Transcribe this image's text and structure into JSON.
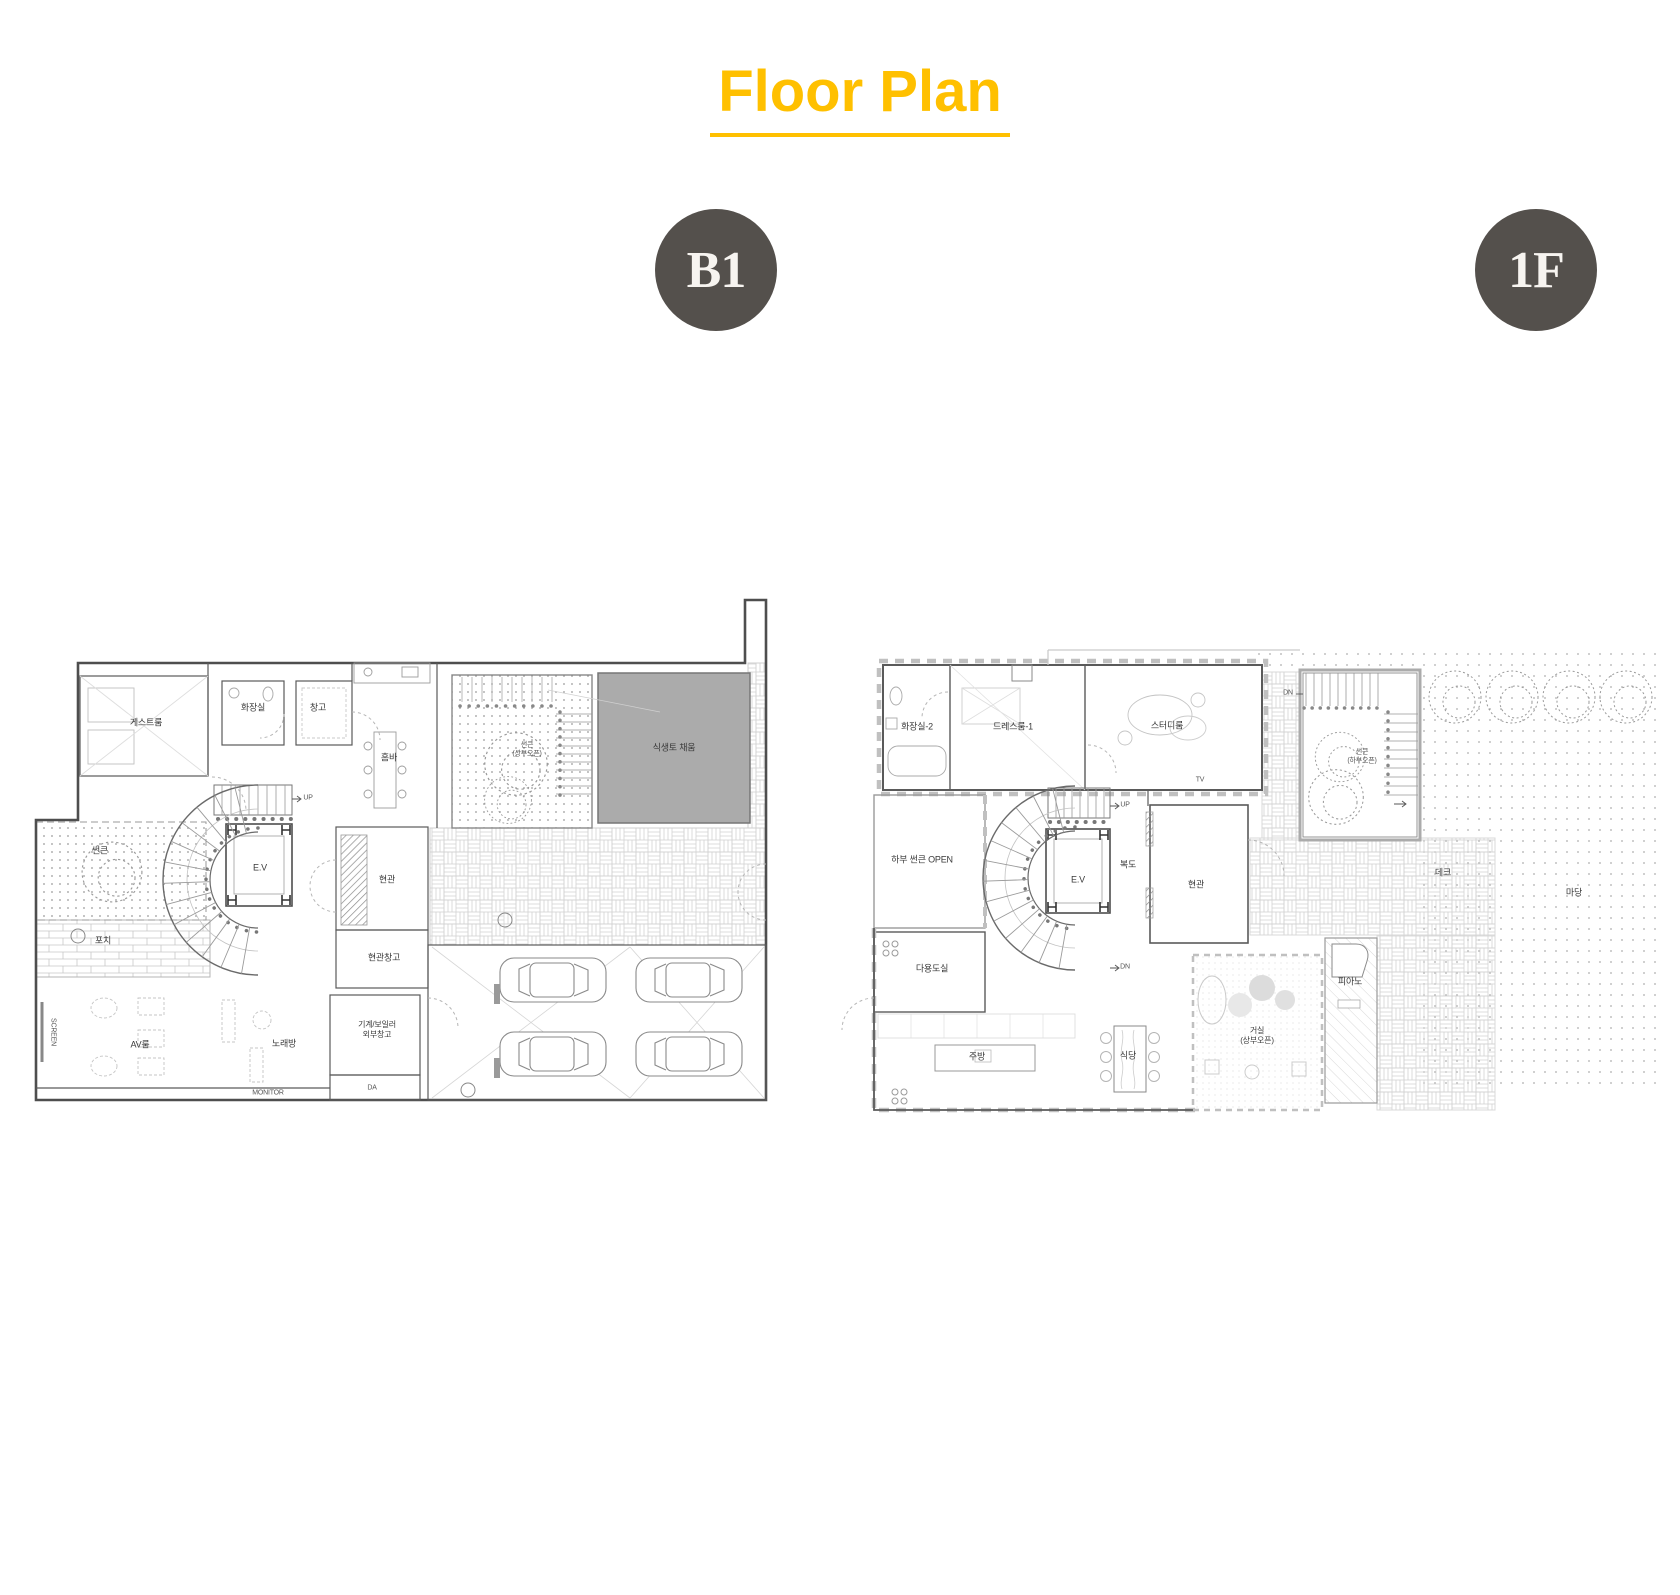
{
  "title": {
    "text": "Floor Plan"
  },
  "colors": {
    "accent": "#FFC000",
    "badge_bg": "#54504C",
    "badge_text": "#F7F4F0",
    "soil_fill": "#ABABAB",
    "wall": "#4E4E4E"
  },
  "badges": {
    "b1": "B1",
    "f1": "1F"
  },
  "plans": {
    "b1": {
      "name": "B1",
      "labels": {
        "guest_room": "게스트룸",
        "toilet": "화장실",
        "storage": "창고",
        "home_bar": "홈바",
        "sunken_top": "썬큰\n(상부오픈)",
        "soil_fill": "식생토 채움",
        "elevator": "E.V",
        "entrance": "현관",
        "entrance_storage": "현관창고",
        "sunken_left": "썬큰",
        "porch": "포치",
        "screen": "SCREEN",
        "av_room": "AV룸",
        "karaoke": "노래방",
        "monitor": "MONITOR",
        "machine_room": "기계/보일러\n외부창고",
        "da": "DA",
        "up": "UP"
      }
    },
    "f1": {
      "name": "1F",
      "labels": {
        "toilet2": "화장실-2",
        "dressroom1": "드레스룸-1",
        "study": "스터디룸",
        "tv": "TV",
        "sunken": "썬큰\n(하부오픈)",
        "dn_top": "DN",
        "lower_sunken_open": "하부 썬큰 OPEN",
        "elevator": "E.V",
        "corridor": "복도",
        "entrance": "현관",
        "up": "UP",
        "dn": "DN",
        "utility": "다용도실",
        "kitchen": "주방",
        "dining": "식당",
        "living": "거실\n(상부오픈)",
        "piano": "피아노",
        "deck": "데크",
        "yard": "마당"
      }
    }
  }
}
